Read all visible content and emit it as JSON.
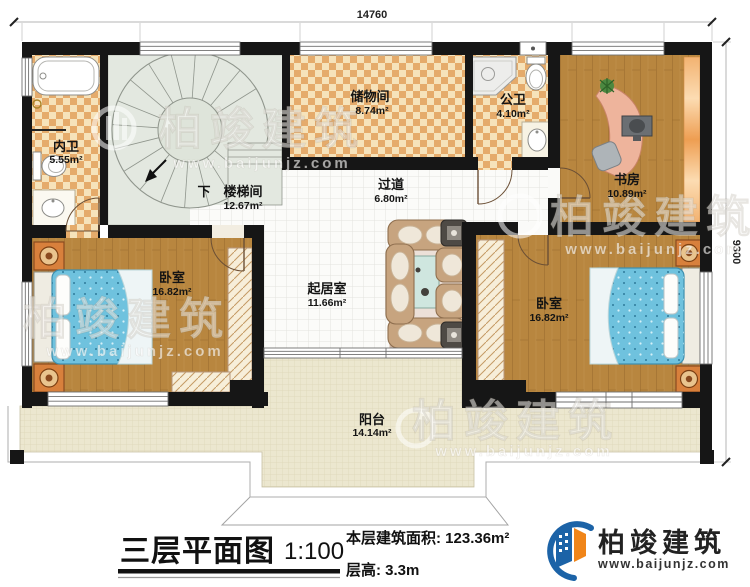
{
  "dimensions": {
    "top": "14760",
    "right": "9300"
  },
  "rooms": {
    "inner_bath": {
      "name": "内卫",
      "area": "5.55m²"
    },
    "stair": {
      "name": "楼梯间",
      "area": "12.67m²",
      "down": "下"
    },
    "storage": {
      "name": "储物间",
      "area": "8.74m²"
    },
    "public_bath": {
      "name": "公卫",
      "area": "4.10m²"
    },
    "study": {
      "name": "书房",
      "area": "10.89m²"
    },
    "bedroom_left": {
      "name": "卧室",
      "area": "16.82m²"
    },
    "living": {
      "name": "起居室",
      "area": "11.66m²"
    },
    "bedroom_right": {
      "name": "卧室",
      "area": "16.82m²"
    },
    "corridor": {
      "name": "过道",
      "area": "6.80m²"
    },
    "balcony": {
      "name": "阳台",
      "area": "14.14m²"
    }
  },
  "title": {
    "name": "三层平面图",
    "scale": "1:100",
    "area_line": "本层建筑面积: 123.36m²",
    "height_line": "层高: 3.3m"
  },
  "logo": {
    "company": "柏竣建筑",
    "website": "www.baijunjz.com"
  },
  "watermark": {
    "company": "柏竣建筑",
    "website": "www.baijunjz.com"
  },
  "colors": {
    "wall": "#161616",
    "checker_light": "#f6e3bb",
    "checker_dark": "#e5ab6b",
    "wood": "#b8863f",
    "stair_floor": "#e3e8e0",
    "tile_grid": "#e3e3de",
    "balcony_floor": "#ece7cf",
    "bed_blue": "#6fc2de",
    "sofa_tan": "#c7a47f",
    "logo_blue": "#1c63a7",
    "logo_orange": "#f08519"
  }
}
